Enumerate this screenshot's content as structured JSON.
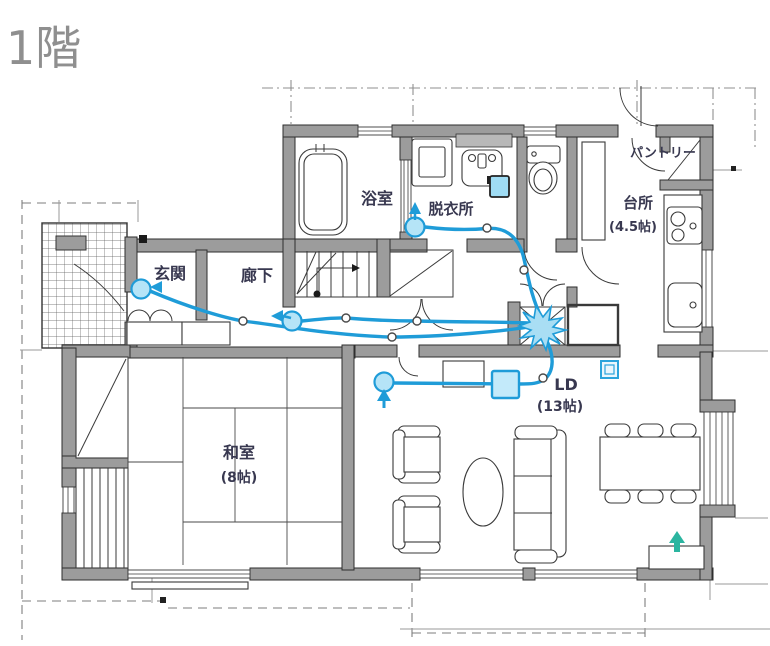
{
  "title": "1階",
  "rooms": {
    "genkan": {
      "label": "玄関"
    },
    "rouka": {
      "label": "廊下"
    },
    "yokushitsu": {
      "label": "浴室"
    },
    "datsuijo": {
      "label": "脱衣所"
    },
    "daidokoro": {
      "label": "台所",
      "size": "(4.5帖)"
    },
    "pantry": {
      "label": "パントリー"
    },
    "washitsu": {
      "label": "和室",
      "size": "(8帖)"
    },
    "ld": {
      "label": "LD",
      "size": "(13帖)"
    }
  },
  "overlay": {
    "hub": "wiring-distribution-hub",
    "outlets": [
      "玄関",
      "廊下",
      "脱衣所",
      "LD"
    ],
    "devices": [
      "wall-controller",
      "router-unit",
      "wall-outlet-plate"
    ],
    "junction_dots": 7
  },
  "colors": {
    "cable": "#1f9cd8",
    "outlet_fill": "#b5e4f7",
    "router_fill": "#c3eafa",
    "hub_fill": "#a9def4",
    "green_arrow": "#2bb5a0",
    "wall": "#9c9c9c",
    "label": "#383850",
    "title": "#8f8f8f"
  }
}
